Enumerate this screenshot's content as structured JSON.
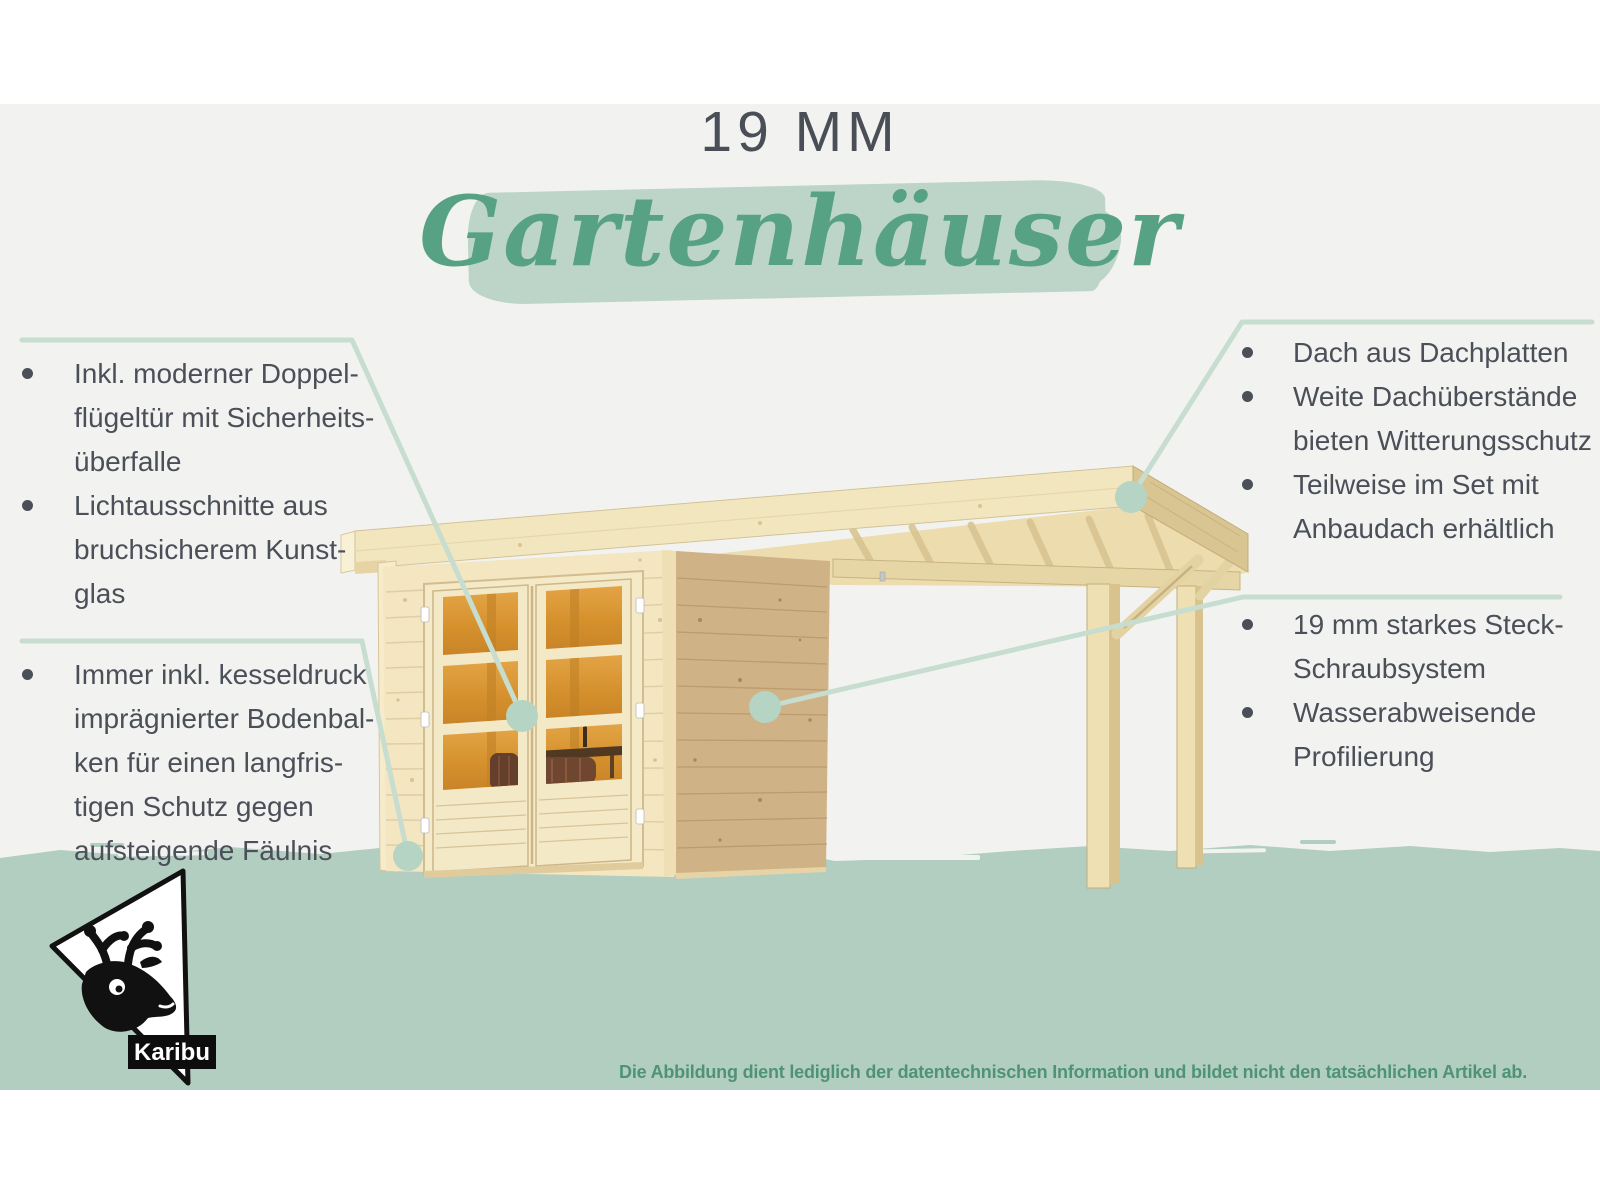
{
  "title": {
    "kicker": "19 MM",
    "script": "Gartenhäuser"
  },
  "callouts": {
    "top_left": {
      "items": [
        {
          "text": "Inkl. moderner Doppel-\nflügeltür mit Sicherheits-\nüberfalle"
        },
        {
          "text": "Lichtausschnitte aus\nbruchsicherem Kunst-\nglas"
        }
      ]
    },
    "bottom_left": {
      "items": [
        {
          "text": "Immer inkl. kesseldruck\nimprägnierter Bodenbal-\nken für einen langfris-\ntigen Schutz gegen\naufsteigende Fäulnis"
        }
      ]
    },
    "top_right": {
      "items": [
        {
          "text": "Dach aus Dachplatten"
        },
        {
          "text": "Weite Dachüberstände\nbieten Witterungsschutz"
        },
        {
          "text": "Teilweise im Set mit\nAnbaudach erhältlich"
        }
      ]
    },
    "bottom_right": {
      "items": [
        {
          "text": "19 mm starkes Steck-\nSchraubsystem"
        },
        {
          "text": "Wasserabweisende\nProfilierung"
        }
      ]
    }
  },
  "logo": {
    "brand": "Karibu"
  },
  "footer": {
    "disclaimer": "Die Abbildung dient lediglich der datentechnischen Information und bildet nicht den tatsächlichen Artikel ab."
  },
  "colors": {
    "text_gray": "#4b4f58",
    "script_green": "#57a184",
    "brush_green": "#bdd5c8",
    "band_green": "#b2cec0",
    "callout_line": "#c6ddd0",
    "callout_dot": "#b5d4c3",
    "footer_green": "#4f9377",
    "wood_light": "#f3e6c0",
    "wood_side": "#cfb286",
    "glass_amber": "#d9942f"
  }
}
